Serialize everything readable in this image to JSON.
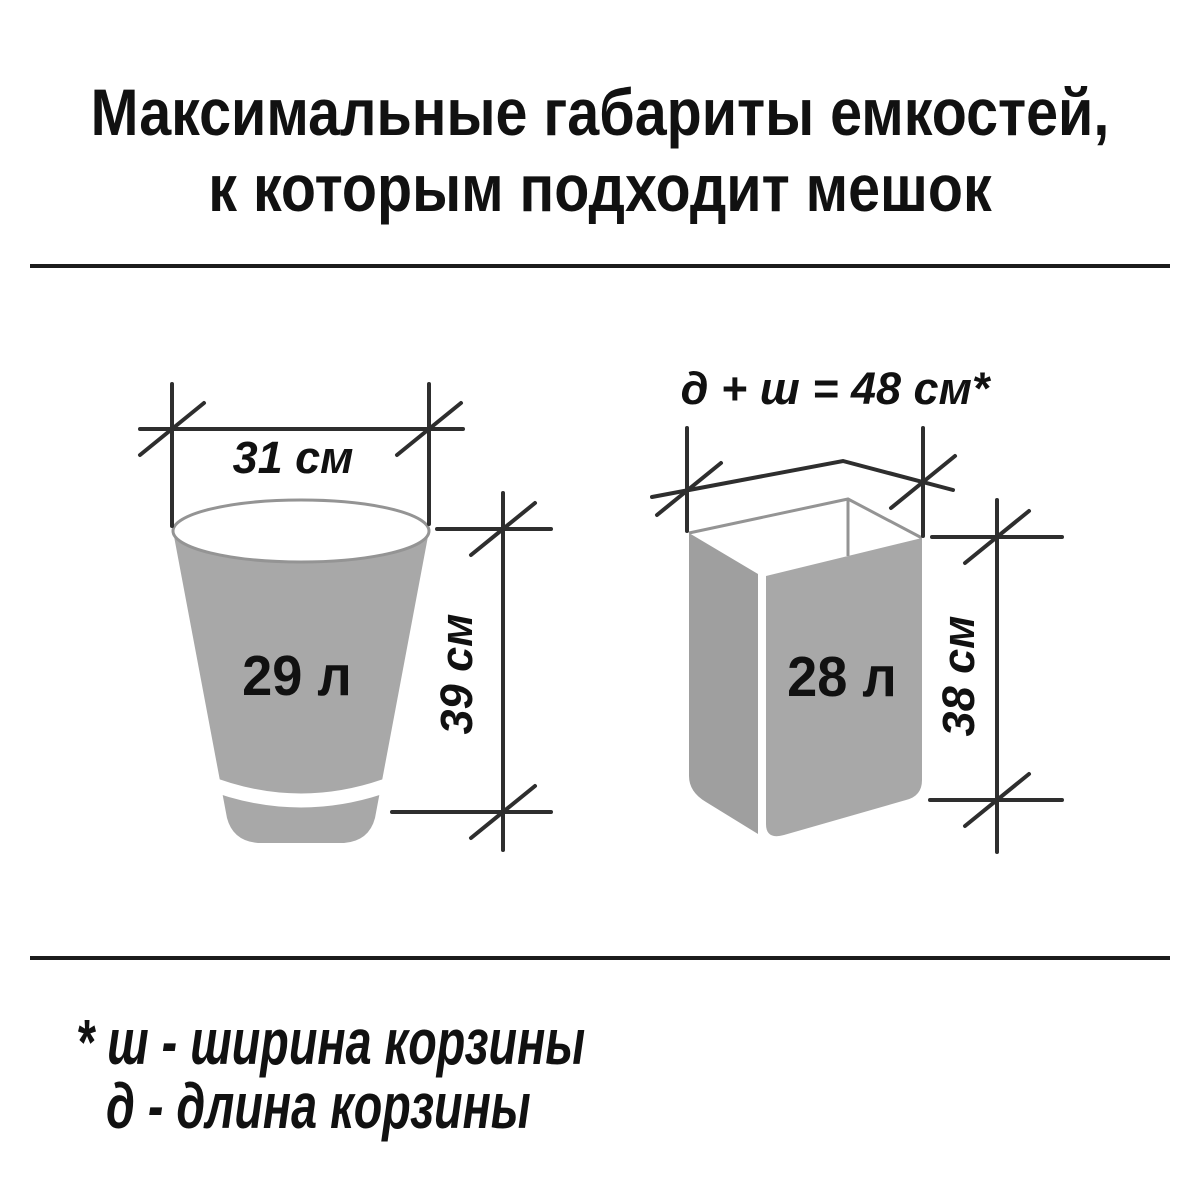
{
  "title": {
    "line1": "Максимальные габариты емкостей,",
    "line2": "к которым подходит мешок"
  },
  "round_bin": {
    "volume_label": "29 л",
    "width_label": "31 см",
    "height_label": "39 см"
  },
  "rect_basket": {
    "perimeter_label": "д + ш = 48 см*",
    "volume_label": "28 л",
    "height_label": "38 см"
  },
  "footnote": {
    "line1": "* ш - ширина корзины",
    "line2": "д - длина корзины"
  },
  "colors": {
    "container_fill": "#a8a8a8",
    "container_fill_dark": "#9f9f9f",
    "dimension_line": "#2e2e2e",
    "thin_outline": "#949494",
    "text": "#111111"
  }
}
